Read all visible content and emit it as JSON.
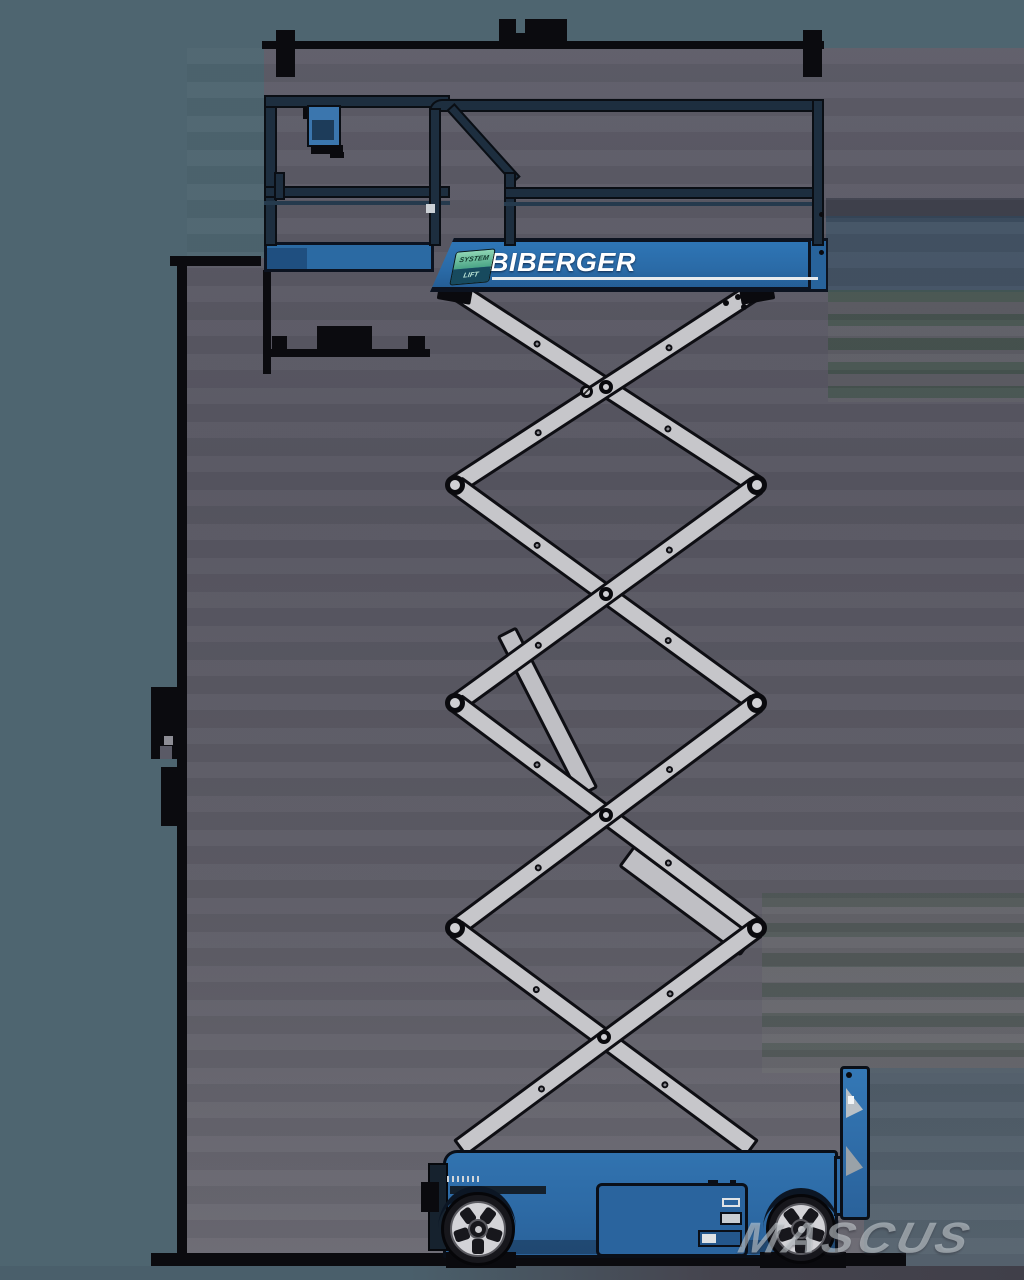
{
  "image": {
    "description": "Side-view technical illustration of an electric scissor lift with raised platform, scissor arms, wheeled chassis and dimension lines",
    "background_outer": "#4e6570",
    "background_inner": "#5b5a66"
  },
  "machine": {
    "brand": "BIBERGER",
    "badge": {
      "line1": "SYSTEM",
      "line2": "LIFT"
    },
    "body_color": "#2e6ca8",
    "rail_color": "#1d2e3f",
    "arm_color": "#c6c6ca"
  },
  "dimensions": {
    "line_color": "#0b0b0f",
    "top_width_line": true,
    "left_height_line": true,
    "ground_line": true
  },
  "watermark": {
    "text": "MASCUS",
    "color": "rgba(210,216,220,0.55)"
  }
}
